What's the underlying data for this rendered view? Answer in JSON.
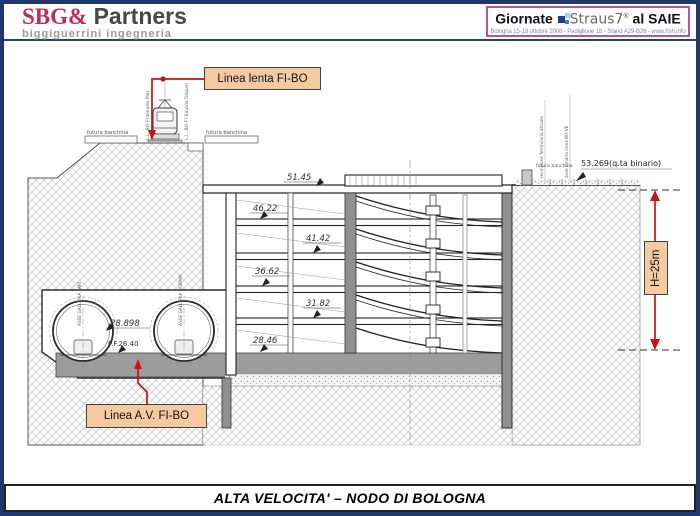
{
  "header": {
    "brand": {
      "name_accent": "SBG&",
      "name_rest": " Partners",
      "tagline": "biggiguerrini ingegneria"
    },
    "event": {
      "word1": "Giornate ",
      "word2": "Straus7",
      "reg": "®",
      "word3": " al SAIE",
      "subtitle": "Bologna 15-18 ottobre 2008 - Padiglione 18 - Stand A29-B28 - www.hsh.info"
    }
  },
  "drawing": {
    "callout_linea_lenta": "Linea lenta FI-BO",
    "callout_linea_av": "Linea A.V. FI-BO",
    "dim_height": "H=25m",
    "elev_track_right": "53.269(q.ta binario)",
    "elevations": [
      "51.45",
      "46.22",
      "41.42",
      "36.62",
      "31.82",
      "28.46"
    ],
    "tunnel": {
      "elev": "28.898",
      "pf": "P.F.26.40",
      "axis_left": "ASSE GALLERIA PARI",
      "axis_right": "ASSE GALLERIA DISPARI"
    },
    "surface": {
      "banchina_left": "futura banchina",
      "banchina_right": "futura banchina",
      "banchina_far_right": "futura banchina",
      "track_left": "L.L. BO-FI binario Pari",
      "track_right": "L.L. BO-FI Binario Dispari",
      "fence": "recinzione ferroviaria attuale",
      "axis_existing": "asse binario linea BO-VE"
    }
  },
  "footer": {
    "title": "ALTA VELOCITA' – NODO DI BOLOGNA"
  },
  "colors": {
    "accent_red": "#cc1111",
    "callout_bg": "#f6caa0",
    "frame_navy": "#20376b",
    "brand_crimson": "#c22a57",
    "slab_gray": "#9c9c9c",
    "event_border": "#b5569c"
  }
}
